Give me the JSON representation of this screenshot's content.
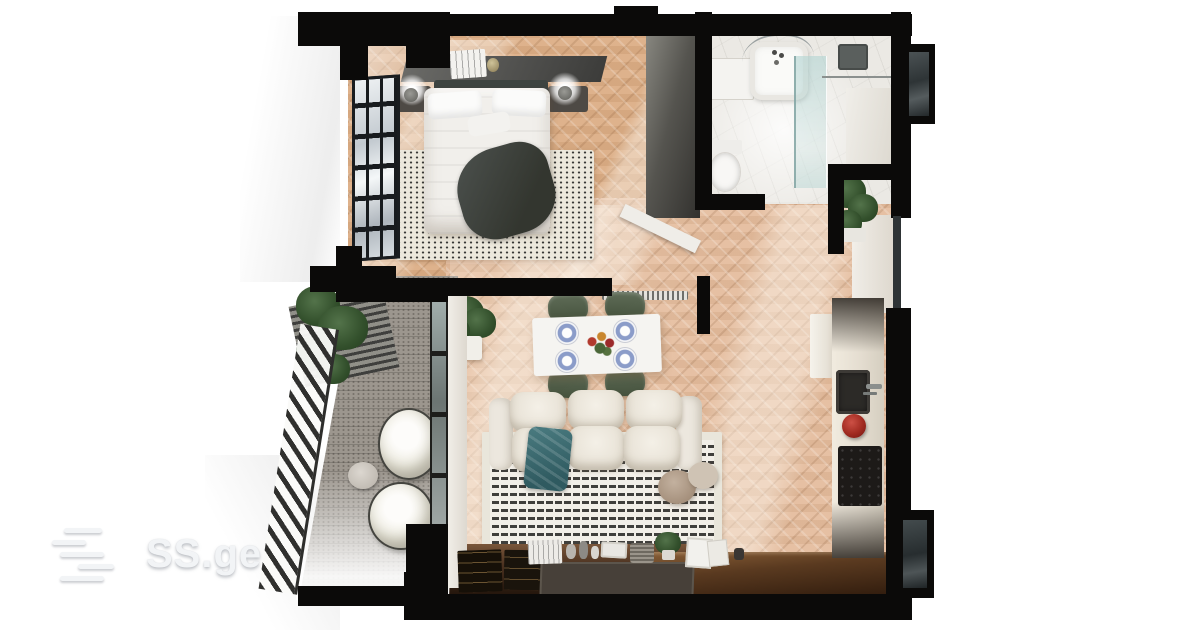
{
  "watermark": {
    "brand": "SS.ge"
  },
  "scene": {
    "description": "3D top-down render of a one-bedroom apartment floor plan",
    "rooms": [
      {
        "name": "bedroom",
        "position": "top-left",
        "items": [
          "double-bed",
          "pillows",
          "dark-throw-blanket",
          "speckled-rug",
          "headboard",
          "nightstand-left",
          "nightstand-right",
          "glowing-lamps",
          "wall-shelf-with-books",
          "wardrobe",
          "panel-window",
          "open-door"
        ]
      },
      {
        "name": "bathroom",
        "position": "top-right",
        "items": [
          "bathtub",
          "curtain-rod",
          "shower-glass",
          "shower-head",
          "vanity-cabinet",
          "toilet",
          "potted-plant"
        ]
      },
      {
        "name": "living-dining-room",
        "position": "center",
        "items": [
          "dining-table",
          "four-green-chairs",
          "blue-place-settings",
          "flower-centerpiece",
          "three-seat-sofa",
          "teal-throw",
          "woven-rug",
          "round-poufs",
          "media-console",
          "decor-objects",
          "potted-plant",
          "radiator"
        ]
      },
      {
        "name": "kitchen",
        "position": "right",
        "items": [
          "fridge",
          "counter",
          "sink",
          "faucet",
          "red-kettle",
          "cooktop",
          "peninsula-counter"
        ]
      },
      {
        "name": "balcony",
        "position": "left",
        "items": [
          "two-bean-bags",
          "side-table",
          "diagonal-railing",
          "slatted-wall",
          "hanging-plants",
          "glass-door"
        ]
      }
    ],
    "colors": {
      "page_bg": "#ffffff",
      "wall": "#0b0a09",
      "wood_floor": "#dcae86",
      "wood_floor_light": "#e5bd9e",
      "marble_floor": "#ebe9e4",
      "stone_floor": "#9c968e",
      "chair_green": "#45523d",
      "throw_teal": "#3e6e74",
      "plate_blue": "#8b9cc9",
      "kettle_red": "#a02a20",
      "logo": "#f2f4f6"
    }
  }
}
